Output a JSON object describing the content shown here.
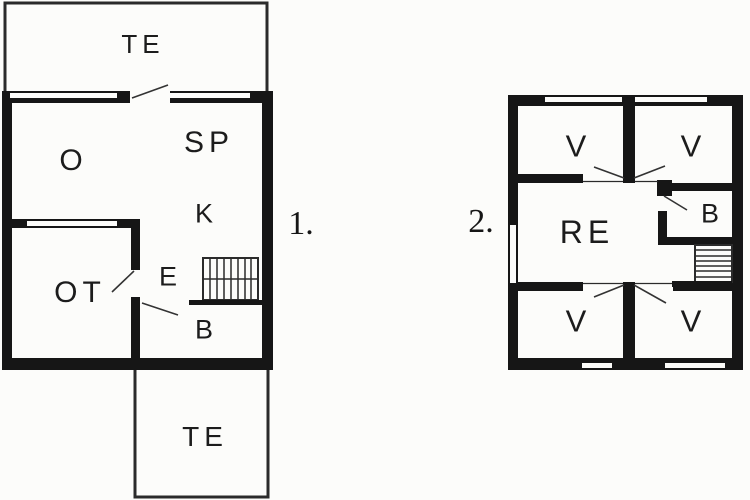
{
  "colors": {
    "background": "#fcfcfa",
    "wall": "#161616",
    "thin_line": "#2b2b2b",
    "door_line": "#333333",
    "text": "#1c1c1c"
  },
  "floor1": {
    "number_label": "1.",
    "rooms": {
      "terrace_top": "TE",
      "o": "O",
      "sp": "SP",
      "k": "K",
      "e": "E",
      "ot": "OT",
      "b": "B",
      "terrace_bottom": "TE"
    }
  },
  "floor2": {
    "number_label": "2.",
    "rooms": {
      "v_top_left": "V",
      "v_top_right": "V",
      "re": "RE",
      "b": "B",
      "v_bottom_left": "V",
      "v_bottom_right": "V"
    }
  }
}
